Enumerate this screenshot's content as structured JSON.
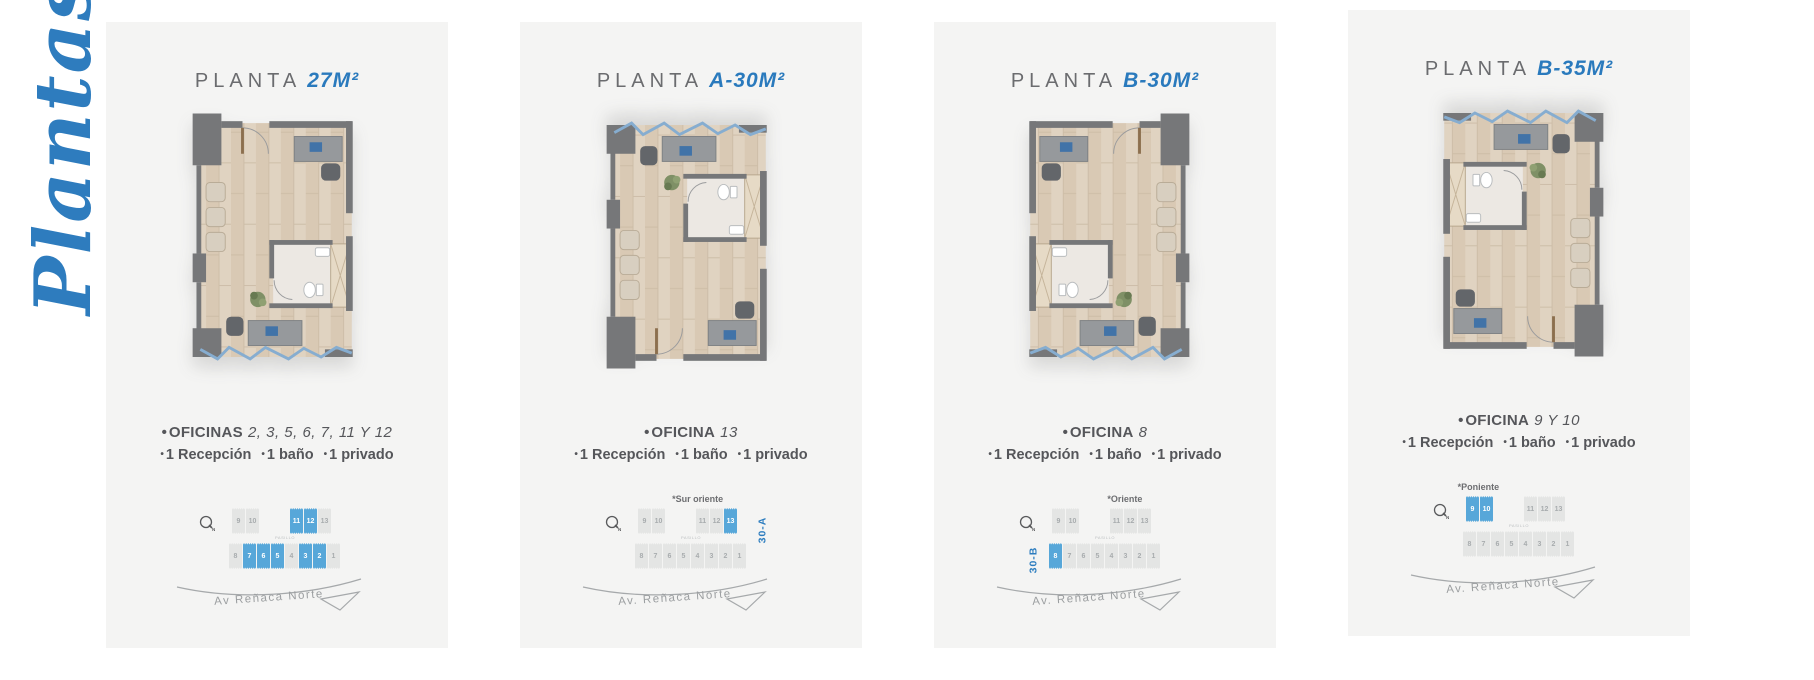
{
  "page": {
    "background": "#ffffff",
    "card_background": "#f4f4f3",
    "accent_blue": "#2a7abd",
    "highlight_blue": "#57a7d9",
    "text_gray": "#55565a",
    "muted_gray": "#9b9ea0",
    "script_blue": "#2e7cbe"
  },
  "glyphs": {
    "bullet": "•",
    "compass_letter": "N"
  },
  "side_label": "Plantas",
  "panels": [
    {
      "title_prefix": "PLANTA",
      "title_size": "27M²",
      "offices_label": "OFICINAS",
      "offices_numbers": "2, 3, 5, 6, 7, 11 Y 12",
      "features": [
        "1 Recepción",
        "1 baño",
        "1 privado"
      ],
      "orientation_label": "",
      "unit_tag": "",
      "unit_tag_side": "",
      "sitemap": {
        "top_row_left": [
          {
            "n": "9",
            "hl": false
          },
          {
            "n": "10",
            "hl": false
          }
        ],
        "top_row_right": [
          {
            "n": "11",
            "hl": true
          },
          {
            "n": "12",
            "hl": true
          },
          {
            "n": "13",
            "hl": false
          }
        ],
        "bottom_row": [
          {
            "n": "8",
            "hl": false
          },
          {
            "n": "7",
            "hl": true
          },
          {
            "n": "6",
            "hl": true
          },
          {
            "n": "5",
            "hl": true
          },
          {
            "n": "4",
            "hl": false
          },
          {
            "n": "3",
            "hl": true
          },
          {
            "n": "2",
            "hl": true
          },
          {
            "n": "1",
            "hl": false
          }
        ],
        "pasillo": "PASILLO",
        "street": "Av  Reñaca Norte"
      }
    },
    {
      "title_prefix": "PLANTA",
      "title_size": "A-30M²",
      "offices_label": "OFICINA",
      "offices_numbers": "13",
      "features": [
        "1 Recepción",
        "1 baño",
        "1 privado"
      ],
      "orientation_label": "*Sur oriente",
      "unit_tag": "30-A",
      "unit_tag_side": "right",
      "sitemap": {
        "top_row_left": [
          {
            "n": "9",
            "hl": false
          },
          {
            "n": "10",
            "hl": false
          }
        ],
        "top_row_right": [
          {
            "n": "11",
            "hl": false
          },
          {
            "n": "12",
            "hl": false
          },
          {
            "n": "13",
            "hl": true
          }
        ],
        "bottom_row": [
          {
            "n": "8",
            "hl": false
          },
          {
            "n": "7",
            "hl": false
          },
          {
            "n": "6",
            "hl": false
          },
          {
            "n": "5",
            "hl": false
          },
          {
            "n": "4",
            "hl": false
          },
          {
            "n": "3",
            "hl": false
          },
          {
            "n": "2",
            "hl": false
          },
          {
            "n": "1",
            "hl": false
          }
        ],
        "pasillo": "PASILLO",
        "street": "Av. Reñaca Norte"
      }
    },
    {
      "title_prefix": "PLANTA",
      "title_size": "B-30M²",
      "offices_label": "OFICINA",
      "offices_numbers": "8",
      "features": [
        "1 Recepción",
        "1 baño",
        "1 privado"
      ],
      "orientation_label": "*Oriente",
      "unit_tag": "30-B",
      "unit_tag_side": "left",
      "sitemap": {
        "top_row_left": [
          {
            "n": "9",
            "hl": false
          },
          {
            "n": "10",
            "hl": false
          }
        ],
        "top_row_right": [
          {
            "n": "11",
            "hl": false
          },
          {
            "n": "12",
            "hl": false
          },
          {
            "n": "13",
            "hl": false
          }
        ],
        "bottom_row": [
          {
            "n": "8",
            "hl": true
          },
          {
            "n": "7",
            "hl": false
          },
          {
            "n": "6",
            "hl": false
          },
          {
            "n": "5",
            "hl": false
          },
          {
            "n": "4",
            "hl": false
          },
          {
            "n": "3",
            "hl": false
          },
          {
            "n": "2",
            "hl": false
          },
          {
            "n": "1",
            "hl": false
          }
        ],
        "pasillo": "PASILLO",
        "street": "Av. Reñaca Norte"
      }
    },
    {
      "title_prefix": "PLANTA",
      "title_size": "B-35M²",
      "offices_label": "OFICINA",
      "offices_numbers": "9 Y 10",
      "features": [
        "1 Recepción",
        "1 baño",
        "1 privado"
      ],
      "orientation_label": "*Poniente",
      "unit_tag": "",
      "unit_tag_side": "",
      "sitemap": {
        "top_row_left": [
          {
            "n": "9",
            "hl": true
          },
          {
            "n": "10",
            "hl": true
          }
        ],
        "top_row_right": [
          {
            "n": "11",
            "hl": false
          },
          {
            "n": "12",
            "hl": false
          },
          {
            "n": "13",
            "hl": false
          }
        ],
        "bottom_row": [
          {
            "n": "8",
            "hl": false
          },
          {
            "n": "7",
            "hl": false
          },
          {
            "n": "6",
            "hl": false
          },
          {
            "n": "5",
            "hl": false
          },
          {
            "n": "4",
            "hl": false
          },
          {
            "n": "3",
            "hl": false
          },
          {
            "n": "2",
            "hl": false
          },
          {
            "n": "1",
            "hl": false
          }
        ],
        "pasillo": "PASILLO",
        "street": "Av. Reñaca Norte"
      }
    }
  ]
}
